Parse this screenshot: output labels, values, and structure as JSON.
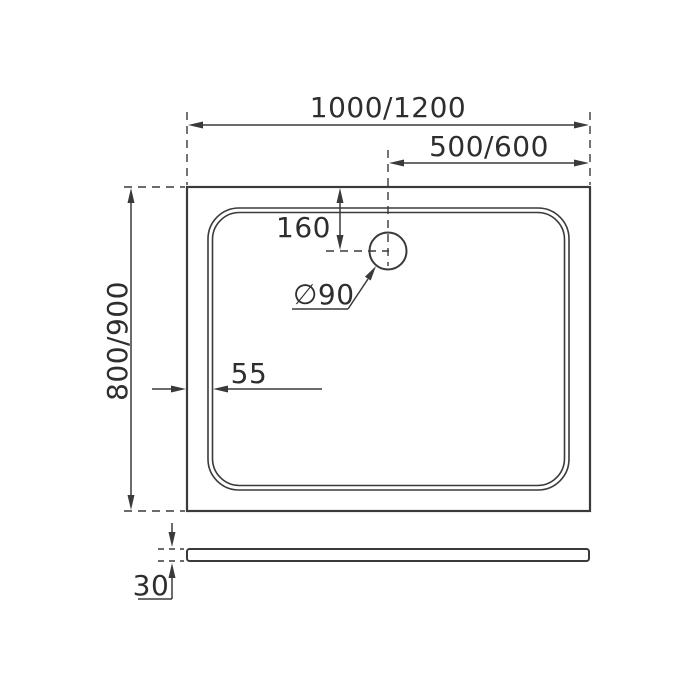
{
  "drawing": {
    "kind": "shower-tray-dimension-drawing",
    "colors": {
      "line": "#3a3a3a",
      "text": "#2e2e2e",
      "background": "#ffffff"
    },
    "top_view": {
      "overall_width_label": "1000/1200",
      "drain_offset_x_label": "500/600",
      "drain_offset_y_label": "160",
      "drain_diameter_label": "∅90",
      "rim_width_label": "55",
      "overall_depth_label": "800/900"
    },
    "side_view": {
      "thickness_label": "30"
    }
  }
}
